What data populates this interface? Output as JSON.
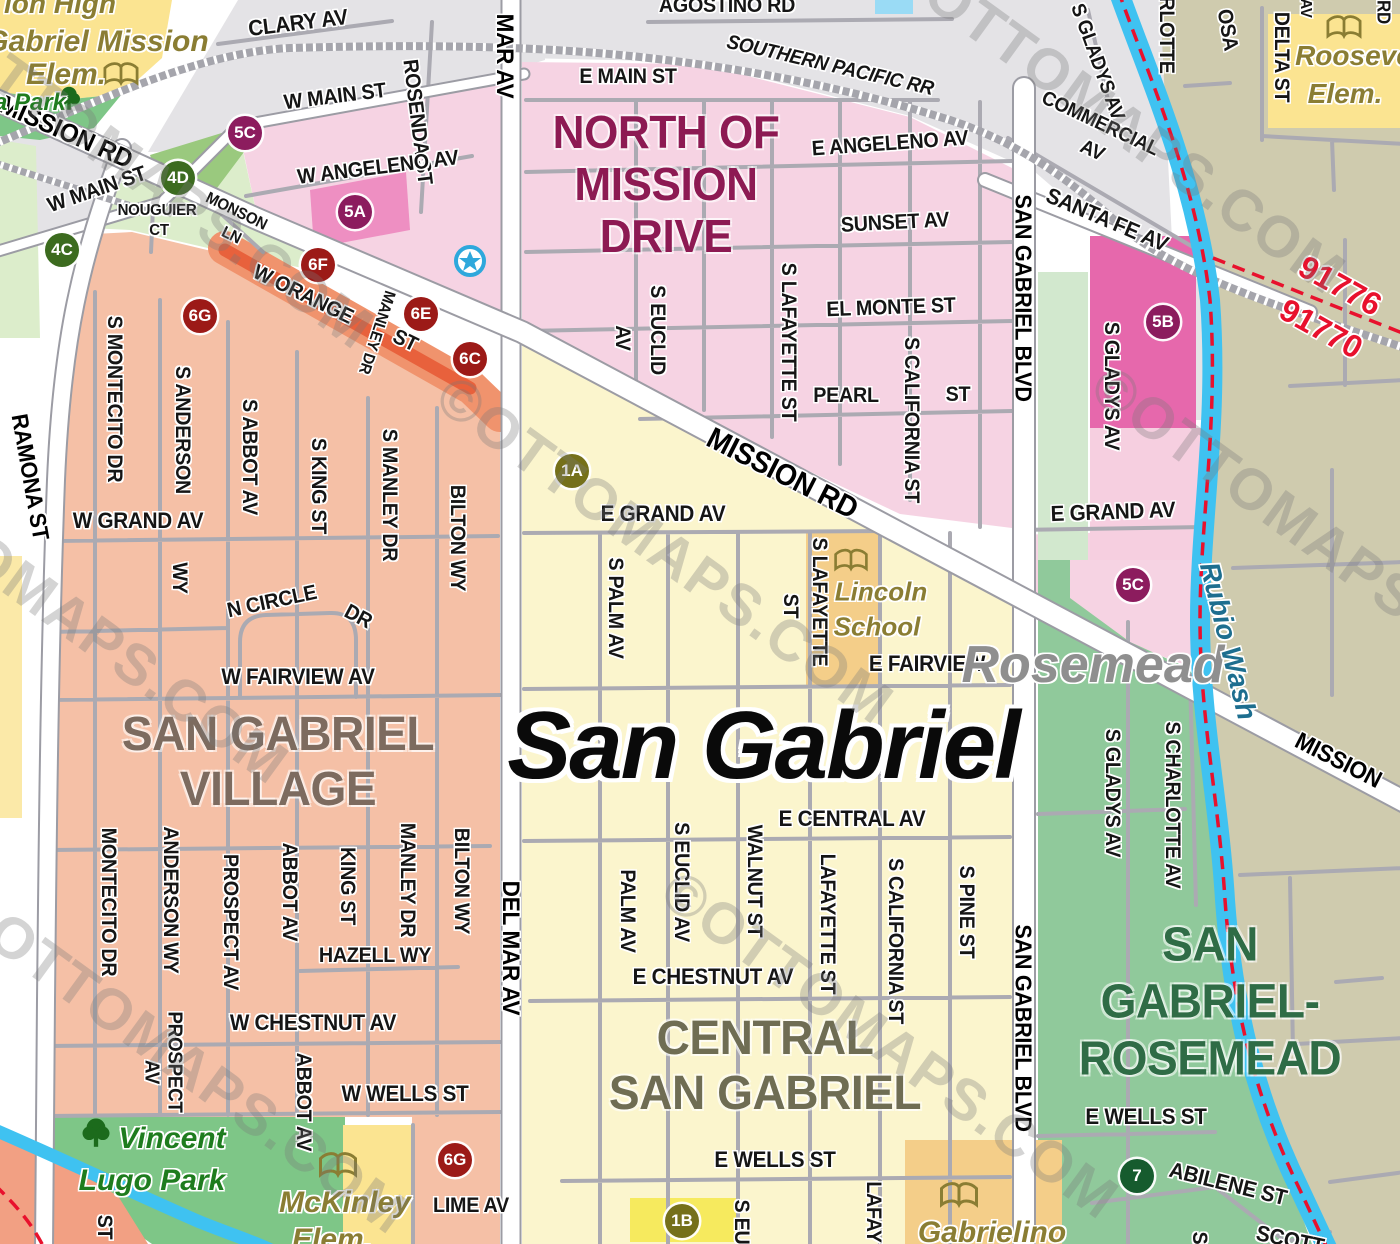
{
  "map_title": "San Gabriel street map",
  "colors": {
    "water": "#3FC2F1",
    "boundary_line": "#E8112D",
    "railroad": "#A5A5AC",
    "district_north_of_mission": "#8D1A53",
    "district_village": "#7D6B5F",
    "district_central": "#6F6D53",
    "district_rosemead": "#2F6C46",
    "badge_purple": "#8C1C5E",
    "badge_green": "#3C6B1F",
    "badge_red": "#9C1A17",
    "badge_olive": "#75701A",
    "badge_darkgreen": "#165B2E"
  },
  "city_labels": [
    {
      "t": "San Gabriel",
      "x": 763,
      "y": 746,
      "s": 96,
      "r": 0,
      "cls": "city-primary",
      "color": "#0a0a0a"
    },
    {
      "t": "Rosemead",
      "x": 1093,
      "y": 665,
      "s": 52,
      "r": 0,
      "cls": "city-secondary",
      "color": "#8F8F8F"
    }
  ],
  "districts": [
    {
      "name": "North of Mission Drive",
      "lines": [
        "NORTH OF",
        "MISSION",
        "DRIVE"
      ],
      "x": 666,
      "y": 184,
      "size": 46,
      "lh": 52,
      "color": "#8D1A53"
    },
    {
      "name": "San Gabriel Village",
      "lines": [
        "SAN GABRIEL",
        "VILLAGE"
      ],
      "x": 278,
      "y": 762,
      "size": 48,
      "lh": 55,
      "color": "#7D6B5F"
    },
    {
      "name": "Central San Gabriel",
      "lines": [
        "CENTRAL",
        "SAN GABRIEL"
      ],
      "x": 765,
      "y": 1066,
      "size": 48,
      "lh": 55,
      "color": "#6F6D53"
    },
    {
      "name": "San Gabriel-Rosemead",
      "lines": [
        "SAN",
        "GABRIEL-",
        "ROSEMEAD"
      ],
      "x": 1210,
      "y": 1002,
      "size": 48,
      "lh": 57,
      "color": "#2F6C46"
    }
  ],
  "streets": [
    {
      "t": "CLARY AV",
      "x": 298,
      "y": 23,
      "r": -7,
      "s": 22
    },
    {
      "t": "AGOSTINO RD",
      "x": 727,
      "y": 6,
      "r": 0,
      "s": 21
    },
    {
      "t": "SOUTHERN PACIFIC RR",
      "x": 830,
      "y": 66,
      "r": 13,
      "s": 20,
      "c": "rr"
    },
    {
      "t": "MISSION RD",
      "x": 66,
      "y": 132,
      "r": 24,
      "s": 26,
      "c": "major"
    },
    {
      "t": "W MAIN ST",
      "x": 97,
      "y": 190,
      "r": -19,
      "s": 21
    },
    {
      "t": "NOUGUIER",
      "x": 157,
      "y": 211,
      "r": 0,
      "s": 16
    },
    {
      "t": "CT",
      "x": 159,
      "y": 231,
      "r": 0,
      "s": 16
    },
    {
      "t": "MONSON",
      "x": 236,
      "y": 212,
      "r": 26,
      "s": 16
    },
    {
      "t": "LN",
      "x": 231,
      "y": 236,
      "r": 26,
      "s": 16
    },
    {
      "t": "W MAIN ST",
      "x": 335,
      "y": 97,
      "r": -7,
      "s": 21
    },
    {
      "t": "ROSENDA ST",
      "x": 417,
      "y": 122,
      "r": 83,
      "s": 21
    },
    {
      "t": "MAR AV",
      "x": 504,
      "y": 56,
      "r": 90,
      "s": 24,
      "c": "major"
    },
    {
      "t": "E MAIN ST",
      "x": 628,
      "y": 77,
      "r": 0,
      "s": 21
    },
    {
      "t": "E ANGELENO AV",
      "x": 890,
      "y": 144,
      "r": -4,
      "s": 21
    },
    {
      "t": "W ANGELENO AV",
      "x": 378,
      "y": 168,
      "r": -7,
      "s": 21
    },
    {
      "t": "SUNSET AV",
      "x": 895,
      "y": 223,
      "r": -3,
      "s": 21
    },
    {
      "t": "EL MONTE ST",
      "x": 891,
      "y": 308,
      "r": -2,
      "s": 21
    },
    {
      "t": "S EUCLID",
      "x": 657,
      "y": 330,
      "r": 90,
      "s": 21
    },
    {
      "t": "AV",
      "x": 622,
      "y": 338,
      "r": 90,
      "s": 21
    },
    {
      "t": "S LAFAYETTE ST",
      "x": 788,
      "y": 342,
      "r": 90,
      "s": 21
    },
    {
      "t": "PEARL",
      "x": 846,
      "y": 396,
      "r": 0,
      "s": 21
    },
    {
      "t": "ST",
      "x": 958,
      "y": 395,
      "r": 0,
      "s": 21
    },
    {
      "t": "S CALIFORNIA ST",
      "x": 911,
      "y": 420,
      "r": 90,
      "s": 21
    },
    {
      "t": "MISSION RD",
      "x": 782,
      "y": 474,
      "r": 27,
      "s": 30,
      "c": "major"
    },
    {
      "t": "E GRAND AV",
      "x": 663,
      "y": 514,
      "r": 0,
      "s": 22
    },
    {
      "t": "E GRAND AV",
      "x": 1113,
      "y": 512,
      "r": -2,
      "s": 22
    },
    {
      "t": "COMMERCIAL",
      "x": 1100,
      "y": 124,
      "r": 25,
      "s": 20
    },
    {
      "t": "AV",
      "x": 1092,
      "y": 151,
      "r": 25,
      "s": 20
    },
    {
      "t": "SANTA FE AV",
      "x": 1107,
      "y": 220,
      "r": 23,
      "s": 22
    },
    {
      "t": "S GLADYS AV",
      "x": 1097,
      "y": 62,
      "r": 70,
      "s": 20
    },
    {
      "t": "SAN GABRIEL BLVD",
      "x": 1023,
      "y": 298,
      "r": 90,
      "s": 23,
      "c": "major"
    },
    {
      "t": "SAN GABRIEL BLVD",
      "x": 1023,
      "y": 1028,
      "r": 90,
      "s": 23,
      "c": "major"
    },
    {
      "t": "DELTA ST",
      "x": 1281,
      "y": 57,
      "r": 90,
      "s": 21
    },
    {
      "t": "RLOTTE",
      "x": 1166,
      "y": 35,
      "r": 90,
      "s": 21
    },
    {
      "t": "OSA",
      "x": 1227,
      "y": 30,
      "r": 80,
      "s": 21
    },
    {
      "t": "AV",
      "x": 1305,
      "y": 8,
      "r": 90,
      "s": 16
    },
    {
      "t": "RD",
      "x": 1383,
      "y": 12,
      "r": 90,
      "s": 18
    },
    {
      "t": "S GLADYS AV",
      "x": 1111,
      "y": 386,
      "r": 90,
      "s": 21
    },
    {
      "t": "RAMONA ST",
      "x": 30,
      "y": 477,
      "r": 80,
      "s": 23,
      "c": "major"
    },
    {
      "t": "W ORANGE",
      "x": 303,
      "y": 295,
      "r": 26,
      "s": 21
    },
    {
      "t": "ST",
      "x": 405,
      "y": 341,
      "r": 26,
      "s": 21
    },
    {
      "t": "MANLEY DR",
      "x": 376,
      "y": 332,
      "r": 108,
      "s": 16
    },
    {
      "t": "S MONTECITO DR",
      "x": 114,
      "y": 399,
      "r": 90,
      "s": 21
    },
    {
      "t": "S ANDERSON",
      "x": 182,
      "y": 430,
      "r": 90,
      "s": 21
    },
    {
      "t": "WY",
      "x": 179,
      "y": 578,
      "r": 90,
      "s": 21
    },
    {
      "t": "S ABBOT AV",
      "x": 249,
      "y": 457,
      "r": 90,
      "s": 21
    },
    {
      "t": "S KING ST",
      "x": 318,
      "y": 486,
      "r": 90,
      "s": 21
    },
    {
      "t": "S MANLEY DR",
      "x": 389,
      "y": 495,
      "r": 90,
      "s": 21
    },
    {
      "t": "BILTON WY",
      "x": 457,
      "y": 538,
      "r": 90,
      "s": 21
    },
    {
      "t": "W GRAND AV",
      "x": 138,
      "y": 521,
      "r": 0,
      "s": 22
    },
    {
      "t": "N CIRCLE",
      "x": 272,
      "y": 602,
      "r": -12,
      "s": 21
    },
    {
      "t": "DR",
      "x": 358,
      "y": 617,
      "r": 28,
      "s": 21
    },
    {
      "t": "W FAIRVIEW AV",
      "x": 298,
      "y": 677,
      "r": 0,
      "s": 22
    },
    {
      "t": "MONTECITO DR",
      "x": 108,
      "y": 902,
      "r": 90,
      "s": 21
    },
    {
      "t": "ANDERSON WY",
      "x": 170,
      "y": 900,
      "r": 90,
      "s": 21
    },
    {
      "t": "PROSPECT AV",
      "x": 230,
      "y": 922,
      "r": 90,
      "s": 21
    },
    {
      "t": "ABBOT AV",
      "x": 289,
      "y": 892,
      "r": 90,
      "s": 21
    },
    {
      "t": "KING ST",
      "x": 347,
      "y": 886,
      "r": 90,
      "s": 21
    },
    {
      "t": "MANLEY DR",
      "x": 407,
      "y": 880,
      "r": 90,
      "s": 21
    },
    {
      "t": "BILTON WY",
      "x": 461,
      "y": 881,
      "r": 90,
      "s": 21
    },
    {
      "t": "HAZELL WY",
      "x": 375,
      "y": 956,
      "r": 0,
      "s": 21
    },
    {
      "t": "W CHESTNUT AV",
      "x": 313,
      "y": 1023,
      "r": 0,
      "s": 22
    },
    {
      "t": "PROSPECT",
      "x": 174,
      "y": 1062,
      "r": 90,
      "s": 20
    },
    {
      "t": "AV",
      "x": 151,
      "y": 1072,
      "r": 90,
      "s": 20
    },
    {
      "t": "ABBOT AV",
      "x": 303,
      "y": 1102,
      "r": 90,
      "s": 21
    },
    {
      "t": "W WELLS ST",
      "x": 405,
      "y": 1094,
      "r": 0,
      "s": 22
    },
    {
      "t": "LIME AV",
      "x": 471,
      "y": 1206,
      "r": 0,
      "s": 21
    },
    {
      "t": "ST",
      "x": 104,
      "y": 1227,
      "r": 90,
      "s": 21
    },
    {
      "t": "DEL MAR AV",
      "x": 510,
      "y": 948,
      "r": 90,
      "s": 24,
      "c": "major"
    },
    {
      "t": "S PALM AV",
      "x": 615,
      "y": 608,
      "r": 90,
      "s": 21
    },
    {
      "t": "ST",
      "x": 790,
      "y": 606,
      "r": 90,
      "s": 21
    },
    {
      "t": "S LAFAYETTE",
      "x": 819,
      "y": 602,
      "r": 90,
      "s": 21
    },
    {
      "t": "E FAIRVIEW",
      "x": 927,
      "y": 664,
      "r": 0,
      "s": 22
    },
    {
      "t": "E CENTRAL AV",
      "x": 852,
      "y": 819,
      "r": 0,
      "s": 22
    },
    {
      "t": "PALM AV",
      "x": 627,
      "y": 911,
      "r": 90,
      "s": 21
    },
    {
      "t": "S EUCLID AV",
      "x": 681,
      "y": 882,
      "r": 90,
      "s": 21
    },
    {
      "t": "WALNUT ST",
      "x": 754,
      "y": 881,
      "r": 90,
      "s": 21
    },
    {
      "t": "LAFAYETTE ST",
      "x": 827,
      "y": 924,
      "r": 90,
      "s": 21
    },
    {
      "t": "S CALIFORNIA ST",
      "x": 895,
      "y": 941,
      "r": 90,
      "s": 21
    },
    {
      "t": "S PINE ST",
      "x": 966,
      "y": 912,
      "r": 90,
      "s": 21
    },
    {
      "t": "E CHESTNUT AV",
      "x": 713,
      "y": 977,
      "r": 0,
      "s": 22
    },
    {
      "t": "E WELLS ST",
      "x": 775,
      "y": 1160,
      "r": 0,
      "s": 22
    },
    {
      "t": "S EU",
      "x": 741,
      "y": 1222,
      "r": 90,
      "s": 21
    },
    {
      "t": "LAFAY",
      "x": 873,
      "y": 1212,
      "r": 90,
      "s": 21
    },
    {
      "t": "E WELLS ST",
      "x": 1146,
      "y": 1117,
      "r": 0,
      "s": 22
    },
    {
      "t": "ABILENE ST",
      "x": 1228,
      "y": 1184,
      "r": 14,
      "s": 22
    },
    {
      "t": "SCOTT",
      "x": 1290,
      "y": 1240,
      "r": 12,
      "s": 22
    },
    {
      "t": "S",
      "x": 1199,
      "y": 1238,
      "r": 90,
      "s": 21
    },
    {
      "t": "S CHARLOTTE AV",
      "x": 1172,
      "y": 805,
      "r": 90,
      "s": 21
    },
    {
      "t": "S GLADYS AV",
      "x": 1112,
      "y": 793,
      "r": 90,
      "s": 21
    },
    {
      "t": "MISSION",
      "x": 1338,
      "y": 761,
      "r": 27,
      "s": 24,
      "c": "major"
    }
  ],
  "schools": [
    {
      "t": "ion High",
      "x": 60,
      "y": 4,
      "s": 28
    },
    {
      "t": "Gabriel Mission",
      "x": 97,
      "y": 42,
      "s": 30
    },
    {
      "t": "Elem.",
      "x": 66,
      "y": 75,
      "s": 30
    },
    {
      "t": "Roosevelt",
      "x": 1362,
      "y": 56,
      "s": 28
    },
    {
      "t": "Elem.",
      "x": 1345,
      "y": 94,
      "s": 28
    },
    {
      "t": "Lincoln",
      "x": 881,
      "y": 592,
      "s": 26
    },
    {
      "t": "School",
      "x": 877,
      "y": 627,
      "s": 26
    },
    {
      "t": "McKinley",
      "x": 345,
      "y": 1203,
      "s": 30
    },
    {
      "t": "Elem.",
      "x": 332,
      "y": 1240,
      "s": 30
    },
    {
      "t": "Gabrielino",
      "x": 992,
      "y": 1233,
      "s": 30
    }
  ],
  "parks": [
    {
      "t": "a Park",
      "x": 30,
      "y": 103,
      "s": 24
    },
    {
      "t": "Vincent",
      "x": 172,
      "y": 1139,
      "s": 30
    },
    {
      "t": "Lugo Park",
      "x": 152,
      "y": 1181,
      "s": 30
    }
  ],
  "water_labels": [
    {
      "t": "Rubio Wash",
      "x": 1228,
      "y": 641,
      "r": 76,
      "s": 28,
      "color": "#1D6E8F"
    }
  ],
  "zipcodes": [
    {
      "t": "91776",
      "x": 1340,
      "y": 286,
      "r": 29,
      "s": 32
    },
    {
      "t": "91770",
      "x": 1321,
      "y": 329,
      "r": 29,
      "s": 32
    }
  ],
  "badges": [
    {
      "t": "5C",
      "x": 245,
      "y": 133,
      "color": "#8C1C5E"
    },
    {
      "t": "5A",
      "x": 355,
      "y": 212,
      "color": "#8C1C5E"
    },
    {
      "t": "5B",
      "x": 1163,
      "y": 322,
      "color": "#8C1C5E"
    },
    {
      "t": "5C",
      "x": 1133,
      "y": 585,
      "color": "#8C1C5E"
    },
    {
      "t": "4D",
      "x": 178,
      "y": 178,
      "color": "#3C6B1F"
    },
    {
      "t": "4C",
      "x": 62,
      "y": 250,
      "color": "#3C6B1F"
    },
    {
      "t": "6F",
      "x": 318,
      "y": 265,
      "color": "#9C1A17"
    },
    {
      "t": "6E",
      "x": 421,
      "y": 314,
      "color": "#9C1A17"
    },
    {
      "t": "6C",
      "x": 470,
      "y": 359,
      "color": "#9C1A17"
    },
    {
      "t": "6G",
      "x": 200,
      "y": 316,
      "color": "#9C1A17"
    },
    {
      "t": "6G",
      "x": 455,
      "y": 1160,
      "color": "#9C1A17"
    },
    {
      "t": "1A",
      "x": 572,
      "y": 471,
      "color": "#75701A"
    },
    {
      "t": "1B",
      "x": 682,
      "y": 1221,
      "color": "#75701A"
    },
    {
      "t": "7",
      "x": 1137,
      "y": 1176,
      "color": "#165B2E"
    }
  ],
  "watermark": {
    "text": "©OTTOMAPS.COM",
    "rotation": 36,
    "positions": [
      [
        145,
        175
      ],
      [
        665,
        550
      ],
      [
        1117,
        120
      ],
      [
        60,
        610
      ],
      [
        890,
        1045
      ],
      [
        180,
        1060
      ],
      [
        1320,
        540
      ]
    ]
  }
}
